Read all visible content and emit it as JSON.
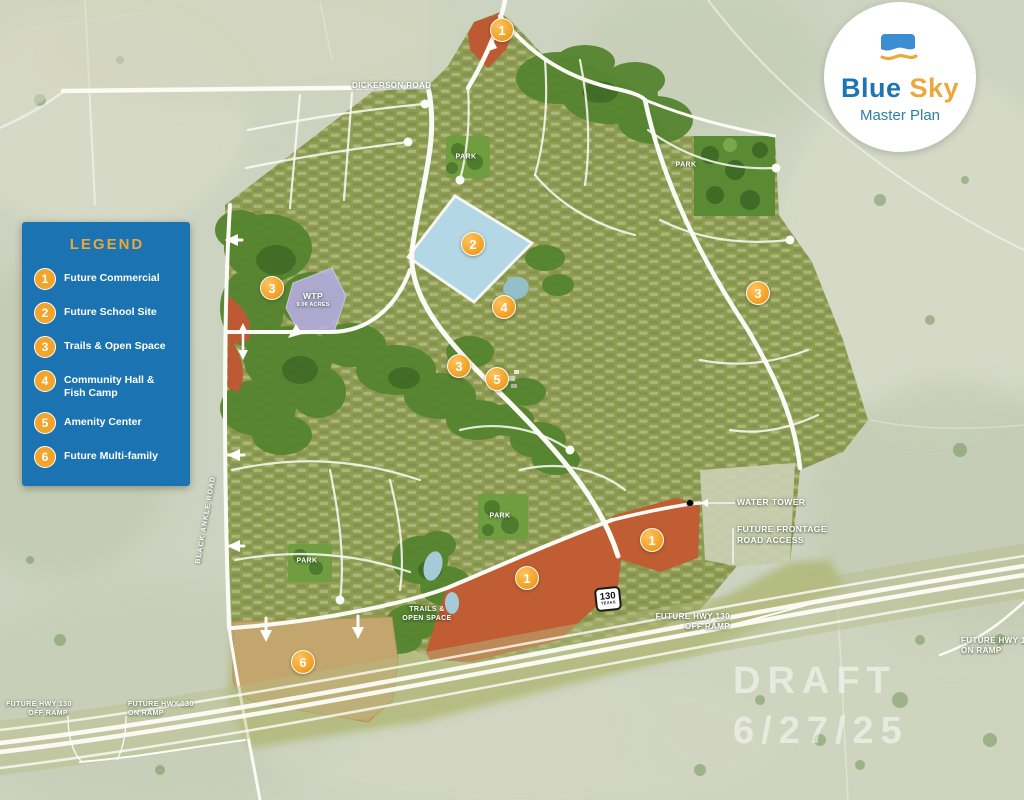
{
  "logo": {
    "brand_blue": "Blue",
    "brand_gold": "Sky",
    "subtitle": "Master Plan"
  },
  "legend": {
    "title": "LEGEND",
    "items": [
      {
        "num": "1",
        "label": "Future Commercial"
      },
      {
        "num": "2",
        "label": "Future School Site"
      },
      {
        "num": "3",
        "label": "Trails & Open Space"
      },
      {
        "num": "4",
        "label": "Community Hall & Fish Camp"
      },
      {
        "num": "5",
        "label": "Amenity Center"
      },
      {
        "num": "6",
        "label": "Future Multi-family"
      }
    ]
  },
  "markers": [
    {
      "num": "1"
    },
    {
      "num": "2"
    },
    {
      "num": "3"
    },
    {
      "num": "3"
    },
    {
      "num": "3"
    },
    {
      "num": "4"
    },
    {
      "num": "5"
    },
    {
      "num": "1"
    },
    {
      "num": "1"
    },
    {
      "num": "6"
    }
  ],
  "map_labels": {
    "dickerson_road": "DICKERSON ROAD",
    "black_ankle_road": "BLACK ANKLE ROAD",
    "park": "PARK",
    "wtp_title": "WTP",
    "wtp_acres": "9.06 ACRES",
    "water_tower": "WATER TOWER",
    "future_frontage_line1": "FUTURE FRONTAGE",
    "future_frontage_line2": "ROAD ACCESS",
    "trails_line1": "TRAILS &",
    "trails_line2": "OPEN SPACE",
    "future_hwy_130": "FUTURE HWY 130",
    "off_ramp": "OFF RAMP",
    "on_ramp": "ON RAMP"
  },
  "highway_shield": {
    "number": "130",
    "state": "TEXAS"
  },
  "draft": {
    "line1": "DRAFT",
    "line2": "6/27/25"
  },
  "colors": {
    "legend_blue": "#1b73b2",
    "marker_orange": "#f2a42c",
    "commercial_orange": "#c05d33",
    "multifamily_tan": "#c2a66d",
    "school_pond_blue": "#b4d7e5",
    "wtp_purple": "#b5addc",
    "logo_blue": "#1f74b4",
    "logo_gold": "#eca93b"
  }
}
